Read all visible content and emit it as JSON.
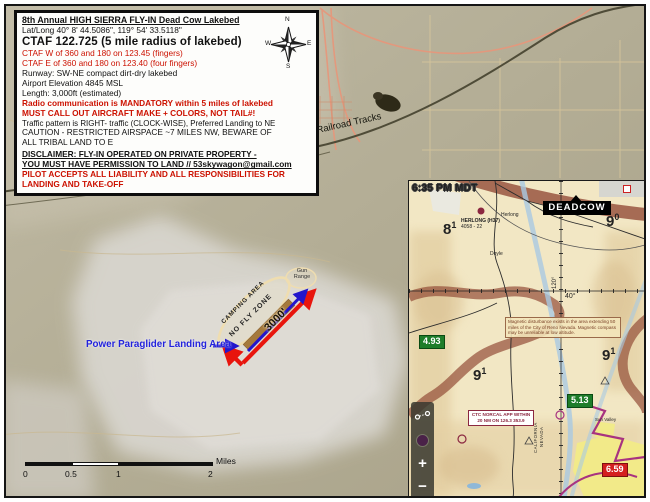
{
  "info_box": {
    "title": "8th Annual HIGH SIERRA FLY-IN Dead Cow Lakebed",
    "lat_long": "Lat/Long   40° 8' 44.5086\", 119° 54' 33.5118\"",
    "ctaf": "CTAF 122.725 (5 mile radius of lakebed)",
    "ctaf_w": "CTAF W of 360 and 180 on 123.45 (fingers)",
    "ctaf_e": "CTAF E of 360 and 180 on 123.40 (four fingers)",
    "runway": "Runway: SW-NE compact dirt-dry lakebed",
    "elevation": "Airport Elevation 4845 MSL",
    "length": "Length: 3,000ft (estimated)",
    "radio_1": "Radio communication is MANDATORY within 5 miles of lakebed",
    "radio_2": "MUST CALL OUT AIRCRAFT MAKE + COLORS, NOT TAIL#!",
    "traffic": "Traffic pattern is RIGHT- traffic (CLOCK-WISE), Preferred Landing to NE",
    "caution_1": "CAUTION - RESTRICTED AIRSPACE ~7 MILES NW, BEWARE OF",
    "caution_2": "ALL TRIBAL LAND TO E",
    "disclaimer_1": "DISCLAIMER: FLY-IN OPERATED ON PRIVATE PROPERTY -",
    "disclaimer_2": "YOU MUST HAVE PERMISSION TO LAND // 53skywagon@gmail.com",
    "liability_1": "PILOT ACCEPTS ALL LIABILITY AND ALL RESPONSIBILITIES FOR",
    "liability_2": "LANDING AND TAKE-OFF"
  },
  "compass": {
    "n": "N",
    "e": "E",
    "s": "S",
    "w": "W"
  },
  "map": {
    "railroad_label": "Railroad Tracks",
    "gun_range": "Gun Range",
    "camping_area": "CAMPING AREA",
    "no_fly_zone": "NO FLY ZONE",
    "runway_length": "3000'",
    "ppg_label": "Power Paraglider Landing Area"
  },
  "scale_bar": {
    "ticks": [
      "0",
      "0.5",
      "1",
      "2"
    ],
    "unit": "Miles"
  },
  "inset": {
    "time": "6:35 PM MDT",
    "deadcow": "DEADCOW",
    "mef": [
      {
        "main": "8",
        "sup": "1"
      },
      {
        "main": "9",
        "sup": "0"
      },
      {
        "main": "9",
        "sup": "1"
      },
      {
        "main": "9",
        "sup": "1"
      }
    ],
    "glide_1": "4.93",
    "glide_2": "5.13",
    "glide_3": "6.59",
    "herlong_airport": "HERLONG (H37)",
    "herlong_data": "4058 - 22",
    "herlong_town": "Herlong",
    "doyle": "Doyle",
    "lat_label": "40°",
    "lon_label": "120°",
    "mag_note": "Magnetic disturbance exists in the area extending 50 miles of the City of Reno Nevada. Magnetic compass may be unreliable at low altitude.",
    "norcal_1": "CTC NORCAL APP WITHIN",
    "norcal_2": "20 NM ON 126.3  353.9",
    "california": "CALIFORNIA",
    "nevada": "NEVADA",
    "sun_valley": "Sun Valley",
    "controls": {
      "plus": "+",
      "minus": "−"
    }
  },
  "colors": {
    "warning_red": "#cc1100",
    "ppg_blue": "#2222dd",
    "glide_green": "#1e7d2a",
    "alert_red": "#d41f1f",
    "runway_brown": "#a5793c"
  }
}
